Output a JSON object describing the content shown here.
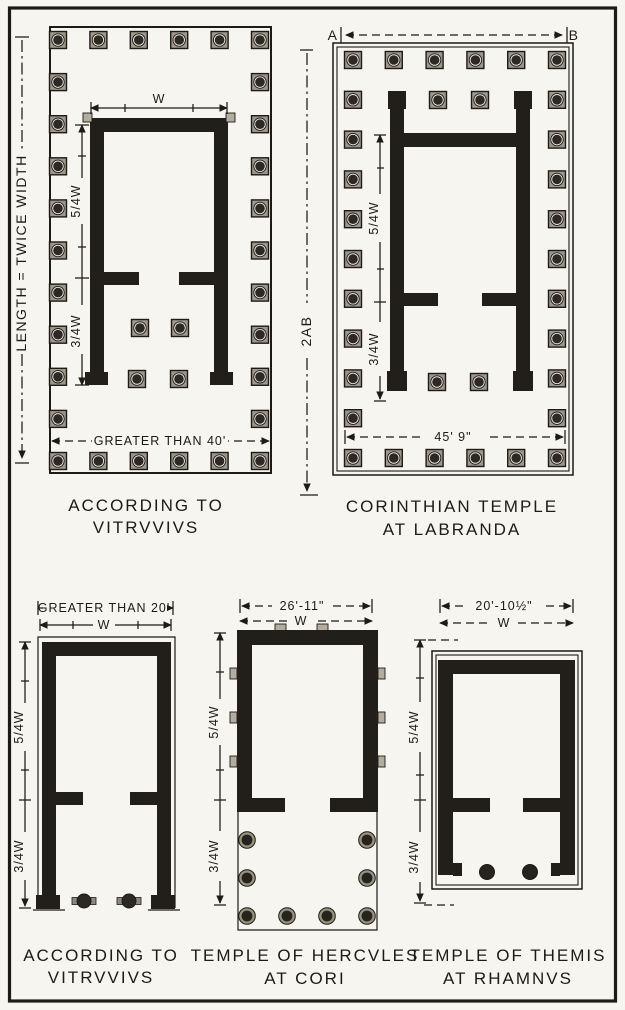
{
  "figure": {
    "type": "architectural plan comparison",
    "colors": {
      "paper": "#f7f5ef",
      "ink": "#1d1a17"
    }
  },
  "plans": {
    "vitruvius_large": {
      "side_label": "LENGTH = TWICE WIDTH",
      "width_label": "W",
      "naos_depth_label": "5/4W",
      "pronaos_depth_label": "3/4W",
      "front_dim_label": "GREATER THAN 40'",
      "caption_line1": "ACCORDING TO",
      "caption_line2": "VITRVVIVS"
    },
    "labranda": {
      "point_a": "A",
      "point_b": "B",
      "length_label": "2AB",
      "naos_depth_label": "5/4W",
      "pronaos_depth_label": "3/4W",
      "front_dim_label": "45' 9\"",
      "caption_line1": "CORINTHIAN TEMPLE",
      "caption_line2": "AT LABRANDA"
    },
    "vitruvius_small": {
      "front_dim_label": "GREATER THAN 20'",
      "width_label": "W",
      "naos_depth_label": "5/4W",
      "pronaos_depth_label": "3/4W",
      "caption_line1": "ACCORDING TO",
      "caption_line2": "VITRVVIVS"
    },
    "cori": {
      "front_dim_label": "26'-11\"",
      "width_label": "W",
      "naos_depth_label": "5/4W",
      "pronaos_depth_label": "3/4W",
      "caption_line1": "TEMPLE OF HERCVLES",
      "caption_line2": "AT CORI"
    },
    "rhamnus": {
      "front_dim_label": "20'-10½\"",
      "width_label": "W",
      "naos_depth_label": "5/4W",
      "pronaos_depth_label": "3/4W",
      "caption_line1": "TEMPLE OF THEMIS",
      "caption_line2": "AT RHAMNVS"
    }
  }
}
